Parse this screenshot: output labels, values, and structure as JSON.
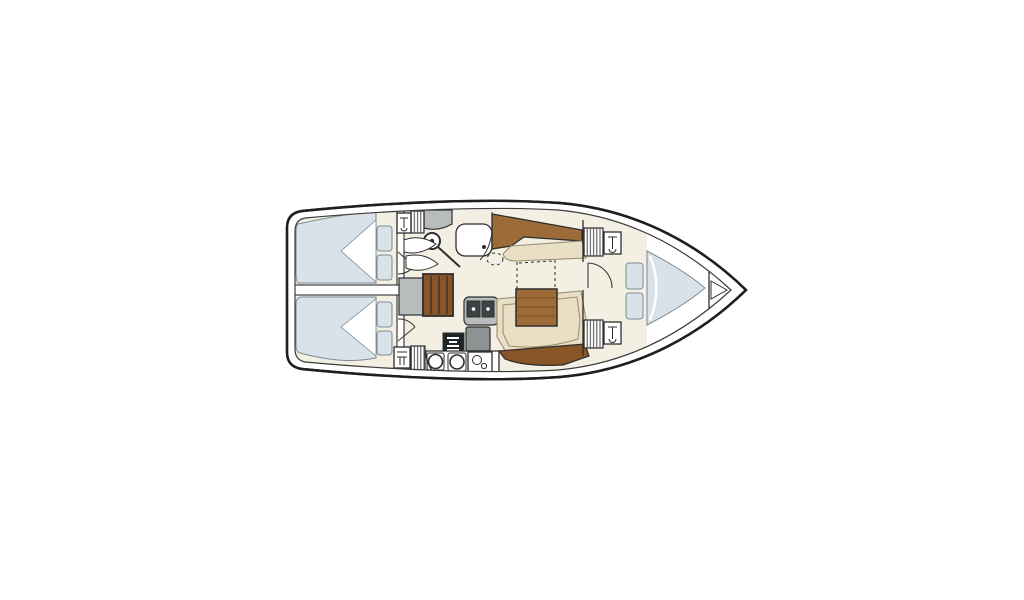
{
  "title": "Sailing yacht interior floor plan (top view), bow to the right",
  "colors": {
    "page_bg": "#ffffff",
    "hull_line": "#1f1f1f",
    "inner_line": "#3c3c3c",
    "deck_white": "#ffffff",
    "floor_cream": "#f3efe2",
    "cushion_blue": "#d9e2e9",
    "cushion_edge": "#7c8b94",
    "seat_beige": "#e9dfc4",
    "beige_edge": "#9a8d6f",
    "wood_brown": "#9c6b38",
    "wood_dark": "#8a5526",
    "wood_grain": "#7c4e20",
    "counter_gray": "#b9bcbc",
    "appliance_gray": "#8d9294",
    "sink_dark": "#3c4345",
    "stove_black": "#212426",
    "line_dark": "#2e2e2e",
    "hatch_line": "#4a4a4a"
  },
  "vessel": {
    "type": "sailboat-floor-plan",
    "orientation": "bow-right-stern-left",
    "areas": [
      {
        "id": "aft-cabin-port",
        "features": [
          "double-berth-mattress",
          "bedding-fold",
          "pillow",
          "pillow",
          "cabin-door"
        ]
      },
      {
        "id": "aft-cabin-starboard",
        "features": [
          "double-berth-mattress",
          "bedding-fold",
          "pillow",
          "pillow",
          "cabin-door"
        ]
      },
      {
        "id": "head",
        "features": [
          "toilet",
          "washbasin",
          "vanity-counter",
          "folding-shower-doors",
          "hanging-locker",
          "cabinet"
        ]
      },
      {
        "id": "companionway",
        "features": [
          "landing-platform",
          "wooden-steps"
        ]
      },
      {
        "id": "galley",
        "features": [
          "double-sink",
          "refrigerator",
          "oven",
          "burner",
          "burner",
          "round-sink",
          "hanging-locker",
          "cabinet"
        ]
      },
      {
        "id": "saloon",
        "features": [
          "port-bench-wood-backrest",
          "port-bench-seat",
          "folding-table",
          "convertible-berth-dashed-outline",
          "settee",
          "wood-trim"
        ]
      },
      {
        "id": "forward-cabin",
        "features": [
          "v-berth-mattress",
          "cushion",
          "cushion",
          "hanging-locker",
          "hanging-locker",
          "cabinet",
          "cabinet",
          "cabin-door"
        ]
      },
      {
        "id": "bow",
        "features": [
          "anchor-locker"
        ]
      }
    ]
  }
}
